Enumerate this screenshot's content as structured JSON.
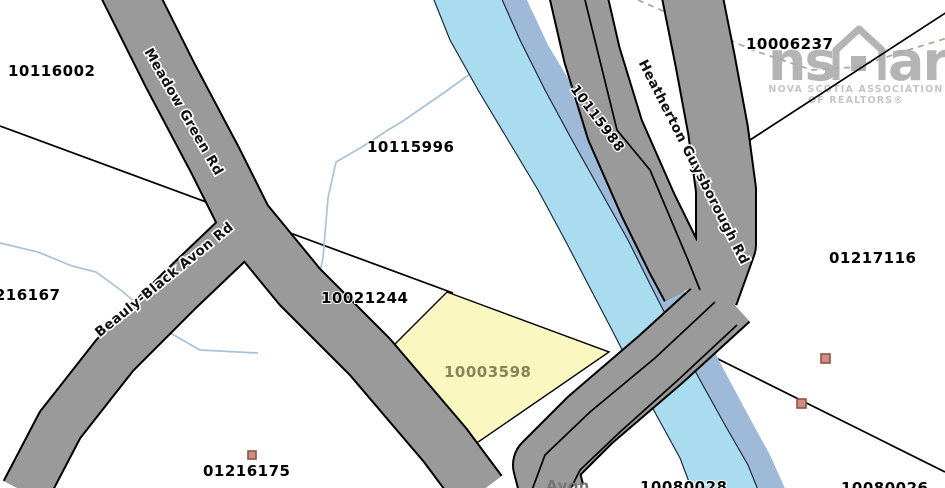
{
  "map_title": "Property parcel map",
  "labels": {
    "p10116002": "10116002",
    "p10006237": "10006237",
    "p10115996": "10115996",
    "p01216167": "01216167",
    "p10021244": "10021244",
    "p10003598": "10003598",
    "p01216175": "01216175",
    "p01217116": "01217116",
    "p10080028": "10080028",
    "p10080026": "10080026",
    "p10115988": "10115988"
  },
  "roads": {
    "meadow": "Meadow Green Rd",
    "beauly": "Beauly-Black Avon Rd",
    "heatherton": "Heatherton Guysborough Rd"
  },
  "river": {
    "name": "Avon"
  },
  "watermark": {
    "logo_left": "ns",
    "logo_right": "ar",
    "line1": "NOVA SCOTIA ASSOCIATION",
    "line2": "OF REALTORS®"
  },
  "colors": {
    "road_fill": "#9A9A9A",
    "road_casing": "#000000",
    "river_light": "#A8DCEE",
    "river_shadow": "#9FB9D9",
    "river_outline": "#1C2B3A",
    "stream": "#A9C2D8",
    "highlight_parcel_fill": "#FAF7C0",
    "highlight_parcel_label": "#85855A",
    "building_fill": "#CC9080",
    "building_border": "#8F5148",
    "dashed_trail": "#B3A99A",
    "watermark_gray": "#ACACAC"
  }
}
